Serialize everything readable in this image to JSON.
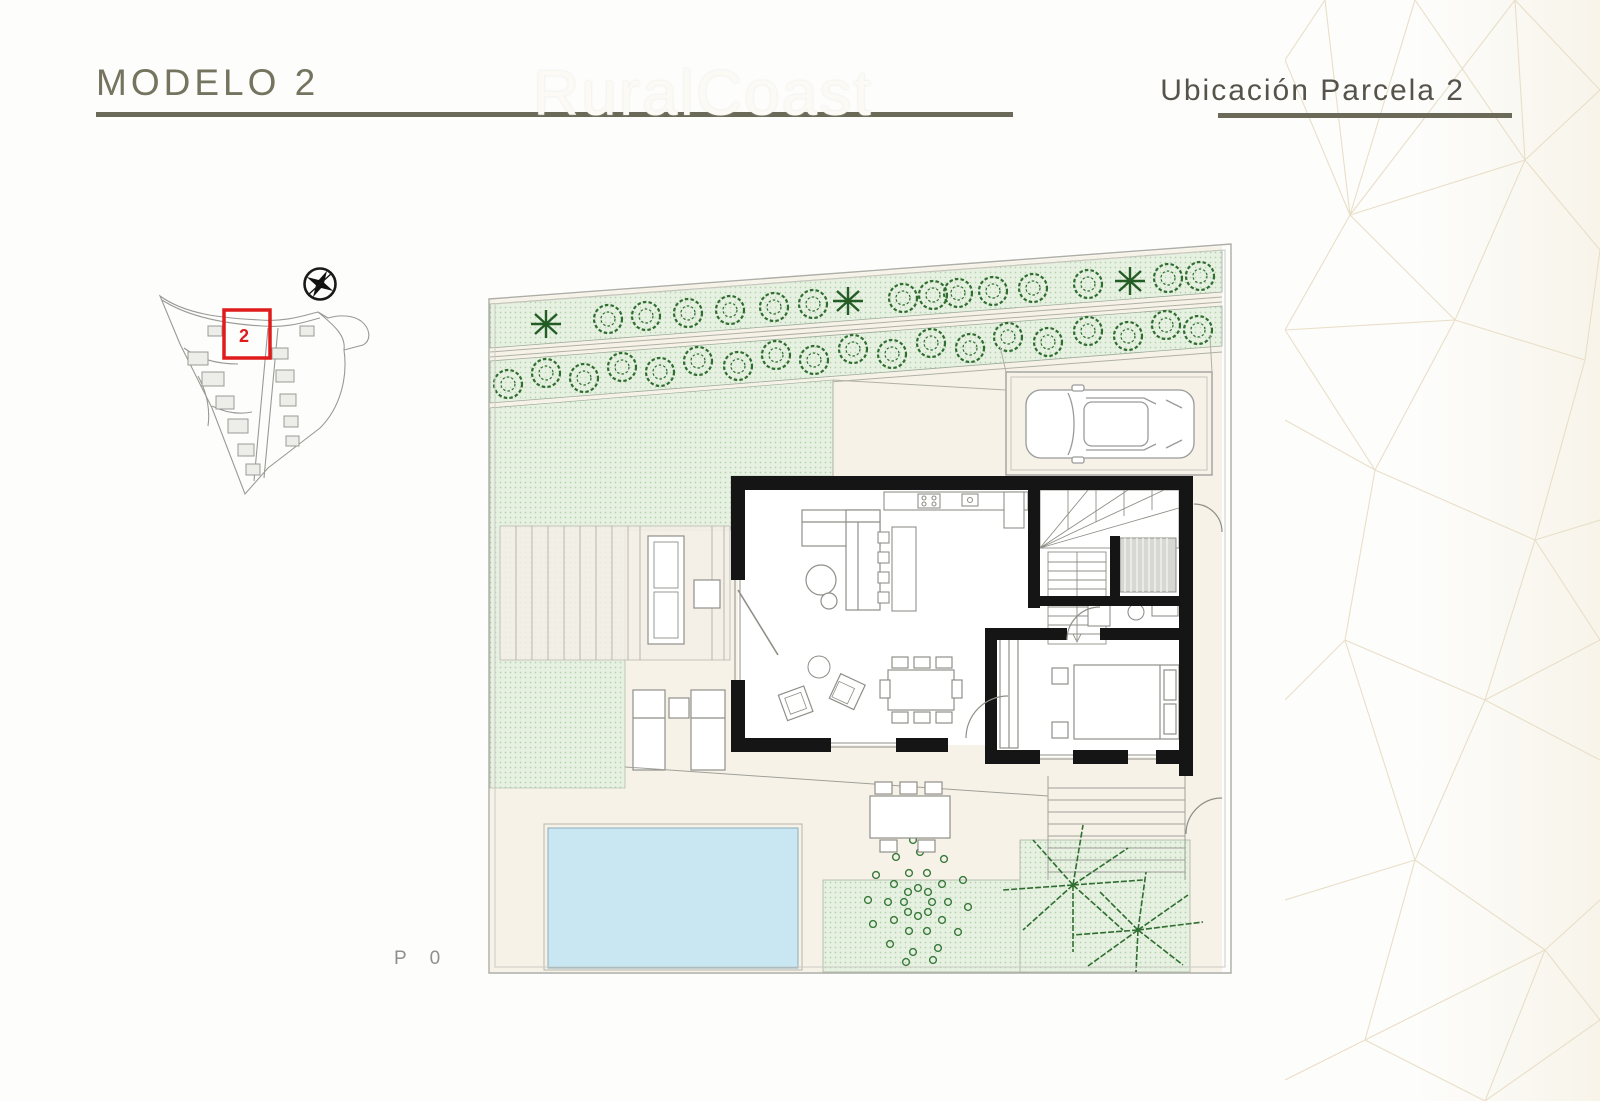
{
  "header": {
    "title": "MODELO 2",
    "subtitle": "Ubicación Parcela 2",
    "watermark": "RuralCoast",
    "accent_color": "#6b6a58",
    "title_color": "#75745f",
    "subtitle_color": "#55534a"
  },
  "site_plan": {
    "parcel_label": "2",
    "highlight_color": "#e01b1b",
    "compass_icon": "compass-icon",
    "line_color": "#9a9a94"
  },
  "floor_plan": {
    "level_label": "P 0",
    "ground_color": "#f6f2e8",
    "wall_color": "#151515",
    "pool_color": "#c9e7f2",
    "lawn_color": "#e7f1e1",
    "tree_color": "#2f6d31",
    "furniture_line_color": "#8f8f88"
  },
  "decor": {
    "mesh_color": "#e9dfc8",
    "mesh_wash_color": "#f6f1e4"
  }
}
